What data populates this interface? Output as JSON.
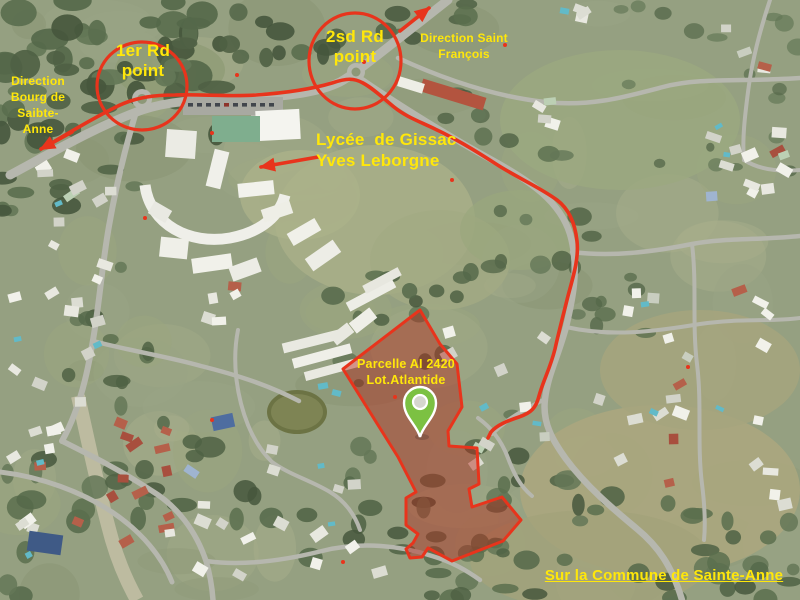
{
  "map": {
    "type": "aerial-satellite-map",
    "annotations": {
      "roundabout1_label": "1er Rd\npoint",
      "roundabout2_label": "2sd Rd\npoint",
      "direction_bourg": "Direction\nBourg de\nSaibte-\nAnne",
      "direction_saint_francois": "Direction Saint\nFrançois",
      "lycee_label": "Lycée  de Gissac\nYves Leborgne",
      "parcel_label": "Parcelle AI 2420\nLot.Atlantide",
      "commune_label": "Sur la Commune de Sainte-Anne"
    },
    "icons": {
      "parcel_pin": "map-pin-icon",
      "route_arrows": "arrowhead-icon"
    },
    "colors": {
      "annotation_red": "#e8341c",
      "label_yellow": "#ffe70a",
      "parcel_fill": "rgba(178,32,18,0.42)",
      "pin_green": "#7cc142"
    }
  }
}
